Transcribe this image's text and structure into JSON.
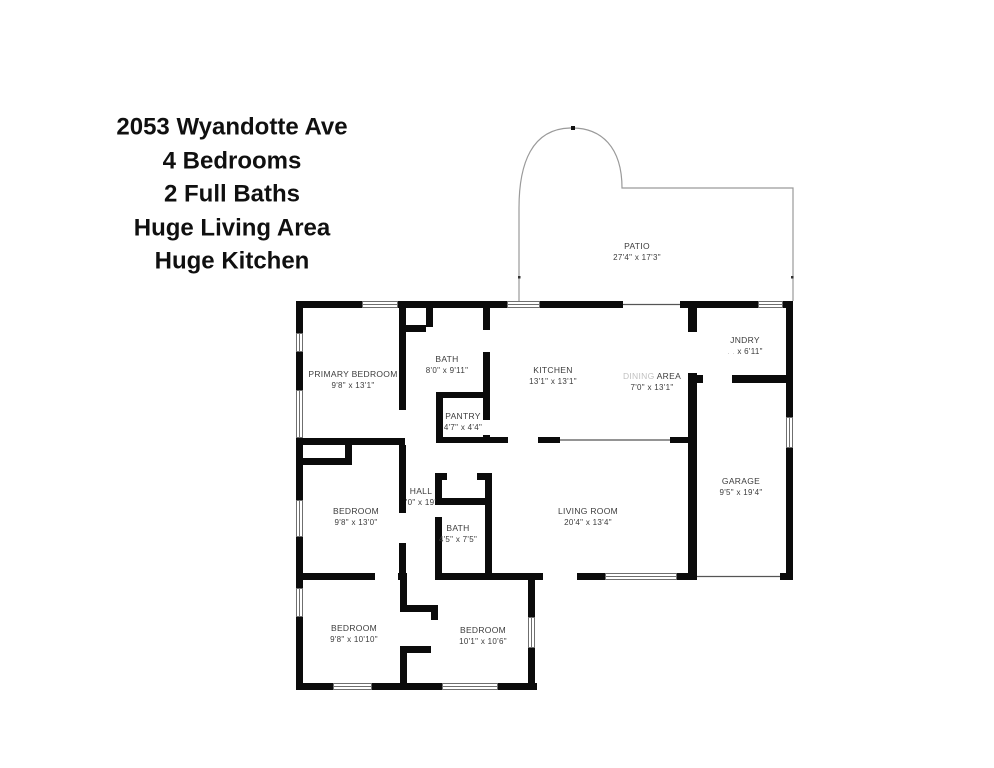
{
  "title_block": {
    "lines": [
      "2053 Wyandotte Ave",
      "4 Bedrooms",
      "2 Full Baths",
      "Huge Living Area",
      "Huge Kitchen"
    ]
  },
  "rooms": {
    "patio": {
      "name": "PATIO",
      "dims": "27'4\" x 17'3\""
    },
    "primary_bedroom": {
      "name": "PRIMARY BEDROOM",
      "dims": "9'8\" x 13'1\""
    },
    "bath_main": {
      "name": "BATH",
      "dims": "8'0\" x 9'11\""
    },
    "kitchen": {
      "name": "KITCHEN",
      "dims": "13'1\" x 13'1\""
    },
    "dining_area": {
      "name_prefix": "DINING",
      "name": "AREA",
      "dims": "7'0\" x 13'1\""
    },
    "laundry": {
      "name": "JNDRY",
      "dims_prefix": ". .",
      "dims": "x 6'11\""
    },
    "pantry": {
      "name": "PANTRY",
      "dims": "4'7\" x 4'4\""
    },
    "bedroom_mid": {
      "name": "BEDROOM",
      "dims": "9'8\" x 13'0\""
    },
    "hall": {
      "name": "HALL",
      "dims": "'0\" x 19'"
    },
    "bath_hall": {
      "name": "BATH",
      "dims": "4'5\" x 7'5\""
    },
    "living_room": {
      "name": "LIVING ROOM",
      "dims": "20'4\" x 13'4\""
    },
    "garage": {
      "name": "GARAGE",
      "dims": "9'5\" x 19'4\""
    },
    "bedroom_bottom_left": {
      "name": "BEDROOM",
      "dims": "9'8\" x 10'10\""
    },
    "bedroom_bottom_right": {
      "name": "BEDROOM",
      "dims": "10'1\" x 10'6\""
    }
  },
  "colors": {
    "background": "#ffffff",
    "wall": "#0b0b0b",
    "patio_outline": "#9a9a9a",
    "label_text": "#3c3c3c",
    "title_text": "#101010"
  }
}
